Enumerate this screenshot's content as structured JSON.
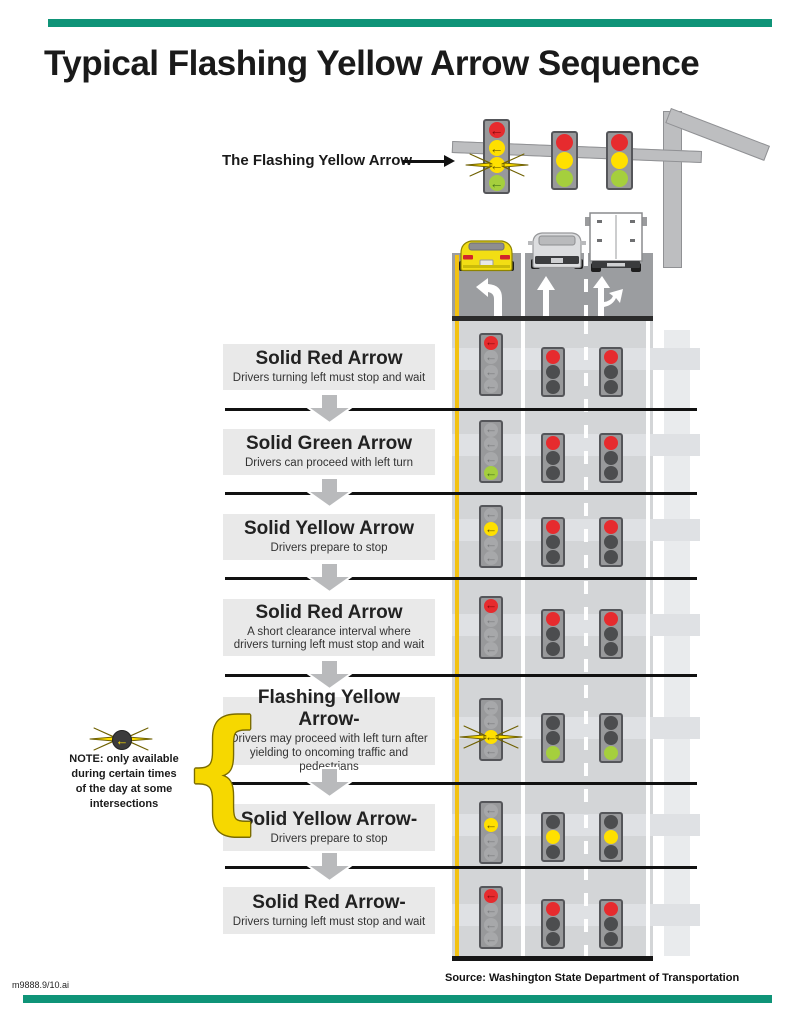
{
  "title": "Typical Flashing Yellow Arrow Sequence",
  "legend": {
    "label": "The Flashing Yellow Arrow",
    "four_section_head": {
      "sections": [
        "red-arrow",
        "yellow-arrow",
        "flashing-yellow-arrow",
        "green-arrow"
      ]
    },
    "three_section_heads": {
      "sections": [
        "red",
        "yellow",
        "green"
      ]
    }
  },
  "intersection": {
    "lanes": [
      {
        "marking": "left-turn-arrow",
        "vehicle": "yellow-car"
      },
      {
        "marking": "straight-arrow",
        "vehicle": "silver-suv"
      },
      {
        "marking": "straight-or-right-arrow",
        "vehicle": "box-truck"
      }
    ]
  },
  "rows": [
    {
      "title": "Solid Red Arrow",
      "desc": "Drivers turning left must stop and wait",
      "left_turn_signal": "solid-red-arrow",
      "through_signals": "red"
    },
    {
      "title": "Solid Green Arrow",
      "desc": "Drivers can proceed with left turn",
      "left_turn_signal": "solid-green-arrow",
      "through_signals": "red"
    },
    {
      "title": "Solid Yellow Arrow",
      "desc": "Drivers prepare to stop",
      "left_turn_signal": "solid-yellow-arrow",
      "through_signals": "red"
    },
    {
      "title": "Solid Red Arrow",
      "desc": "A short clearance interval where drivers turning left must stop and wait",
      "left_turn_signal": "solid-red-arrow",
      "through_signals": "red"
    },
    {
      "title": "Flashing Yellow Arrow-",
      "desc": "Drivers may proceed with left turn after yielding to oncoming traffic and pedestrians",
      "left_turn_signal": "flashing-yellow-arrow",
      "through_signals": "green"
    },
    {
      "title": "Solid Yellow Arrow-",
      "desc": "Drivers prepare to stop",
      "left_turn_signal": "solid-yellow-arrow",
      "through_signals": "yellow"
    },
    {
      "title": "Solid Red Arrow-",
      "desc": "Drivers turning left must stop and wait",
      "left_turn_signal": "solid-red-arrow",
      "through_signals": "red"
    }
  ],
  "note": {
    "icon": "flashing-yellow-arrow-icon",
    "text": "NOTE: only available during certain times of the day at some intersections"
  },
  "footer": {
    "source": "Source: Washington State Department of Transportation",
    "file_id": "m9888.9/10.ai"
  },
  "colors": {
    "accent_green": "#0f9478",
    "signal_red": "#e62b2e",
    "signal_yellow": "#ffe000",
    "signal_green": "#a5cf3d",
    "road_dark": "#9b9da0",
    "road_light": "#d3d5d7",
    "lane_line_yellow": "#f3c211"
  }
}
